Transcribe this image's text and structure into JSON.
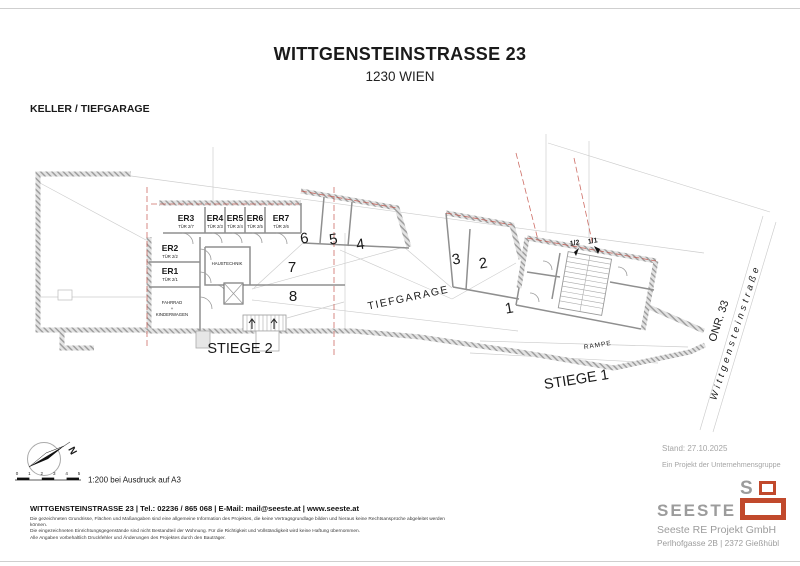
{
  "header": {
    "title": "WITTGENSTEINSTRASSE 23",
    "subtitle": "1230 WIEN",
    "drawing_label": "KELLER / TIEFGARAGE"
  },
  "plan": {
    "storage_rooms": [
      {
        "name": "ER3",
        "door": "TÜR 2/7"
      },
      {
        "name": "ER4",
        "door": "TÜR 2/3"
      },
      {
        "name": "ER5",
        "door": "TÜR 2/4"
      },
      {
        "name": "ER6",
        "door": "TÜR 2/5"
      },
      {
        "name": "ER7",
        "door": "TÜR 2/6"
      },
      {
        "name": "ER2",
        "door": "TÜR 2/2"
      },
      {
        "name": "ER1",
        "door": "TÜR 2/1"
      }
    ],
    "rooms": {
      "haustechnik": "HAUSTECHNIK",
      "fahrrad": "FAHRRAD",
      "fahrrad_plus": "+",
      "kinderwagen": "KINDERWAGEN"
    },
    "parking_spaces": [
      "1",
      "2",
      "3",
      "4",
      "5",
      "6",
      "7",
      "8"
    ],
    "labels": {
      "tiefgarage": "TIEFGARAGE",
      "stiege1": "STIEGE 1",
      "stiege2": "STIEGE 2",
      "rampe": "RAMPE",
      "onr": "ONR. 33",
      "street": "Wittgensteinstraße",
      "unit_1_2": "1/2",
      "unit_1_1": "1/1"
    }
  },
  "compass": {
    "north": "N"
  },
  "scalebar": {
    "ticks": [
      "0",
      "1",
      "2",
      "3",
      "4",
      "5"
    ],
    "label": "1:200 bei Ausdruck auf A3"
  },
  "footer": {
    "contact": "WITTGENSTEINSTRASSE 23 | Tel.: 02236 / 865 068 | E-Mail: mail@seeste.at | www.seeste.at",
    "disclaimer": [
      "Die gezeichneten Grundrisse, Flächen und Maßangaben sind eine allgemeine Information des Projektes, die keine Vertragsgrundlage bilden und hieraus keine Rechtsansprüche abgeleitet werden können.",
      "Die eingezeichneten Einrichtungsgegenstände sind nicht Bestandteil der Wohnung. Für die Richtigkeit und Vollständigkeit wird keine Haftung übernommen.",
      "Alle Angaben vorbehaltlich Druckfehler und Änderungen des Projektes durch den Bauträger."
    ],
    "stand": "Stand: 27.10.2025",
    "group_line": "Ein Projekt der Unternehmensgruppe",
    "logo_wordmark": "SEESTE",
    "logo_letter": "S",
    "company": "Seeste RE Projekt GmbH",
    "company_address": "Perlhofgasse 2B | 2372 Gießhübl"
  },
  "colors": {
    "logo_orange": "#c1492c",
    "logo_gray": "#9c9c9c",
    "section_red": "#c4534a",
    "wall_gray": "#9b9b9b"
  }
}
